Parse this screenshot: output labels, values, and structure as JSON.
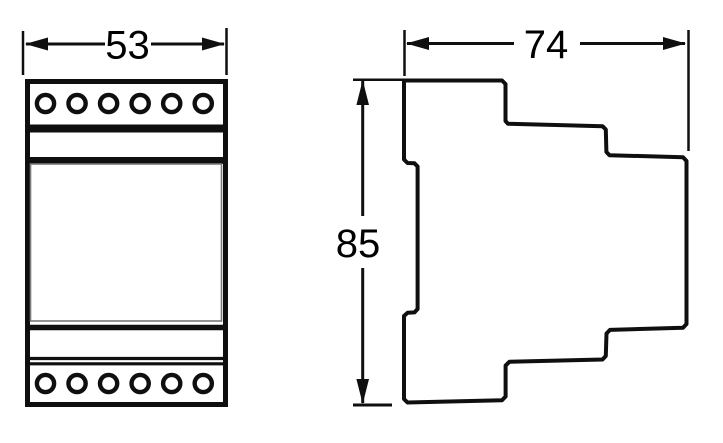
{
  "drawing": {
    "front_view": {
      "width_label": "53",
      "terminal_rows": 2,
      "terminals_per_row": 6
    },
    "side_view": {
      "depth_label": "74",
      "height_label": "85"
    },
    "colors": {
      "line": "#0f0f0f",
      "panel_line": "#7a7a7a",
      "background": "#ffffff",
      "label": "#000000"
    }
  }
}
